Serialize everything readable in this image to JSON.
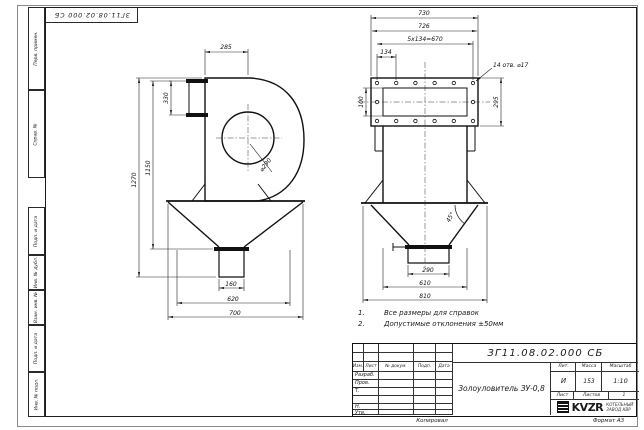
{
  "sheet": {
    "corner_stamp": "ЗГ11.08.02.000 СБ",
    "copied": "Копировал",
    "format": "Формат А3"
  },
  "margin_cells": [
    "Перв. примен.",
    "Справ. №",
    "Подп. и дата",
    "Инв. № дубл.",
    "Взам. инв. №",
    "Подп. и дата",
    "Инв. № подл."
  ],
  "notes": [
    {
      "num": "1.",
      "text": "Все размеры для справок"
    },
    {
      "num": "2.",
      "text": "Допустимые отклонения ±50мм"
    }
  ],
  "views": {
    "side": {
      "dim_285": "285",
      "dim_330": "330",
      "dim_1150": "1150",
      "dim_1270": "1270",
      "inlet_dia": "⌀290",
      "dim_160": "160",
      "dim_620": "620",
      "dim_700": "700"
    },
    "front": {
      "dim_730": "730",
      "dim_726": "726",
      "dim_pitch": "5x134=670",
      "dim_134": "134",
      "holes_note": "14 отв. ⌀17",
      "dim_100": "100",
      "dim_295": "295",
      "angle": "45°",
      "dim_290": "290",
      "dim_610": "610",
      "dim_810": "810"
    }
  },
  "title_block": {
    "doc_number": "ЗГ11.08.02.000 СБ",
    "title": "Золоуловитель ЗУ-0,8",
    "columns": [
      "Изм.",
      "Лист",
      "№ докум.",
      "Подп.",
      "Дата"
    ],
    "rows": [
      "Разраб.",
      "Пров.",
      "Т. контр.",
      "Н. контр.",
      "Утв."
    ],
    "lit_label": "Лит.",
    "mass_label": "Масса",
    "scale_label": "Масштаб",
    "lit_value": "И",
    "mass_value": "153",
    "scale_value": "1:10",
    "sheet_label": "Лист",
    "sheets_label": "Листов",
    "sheets_value": "1",
    "logo_text": "KVZR",
    "company_line1": "КОТЕЛЬНЫЙ",
    "company_line2": "ЗАВОД КВР"
  }
}
